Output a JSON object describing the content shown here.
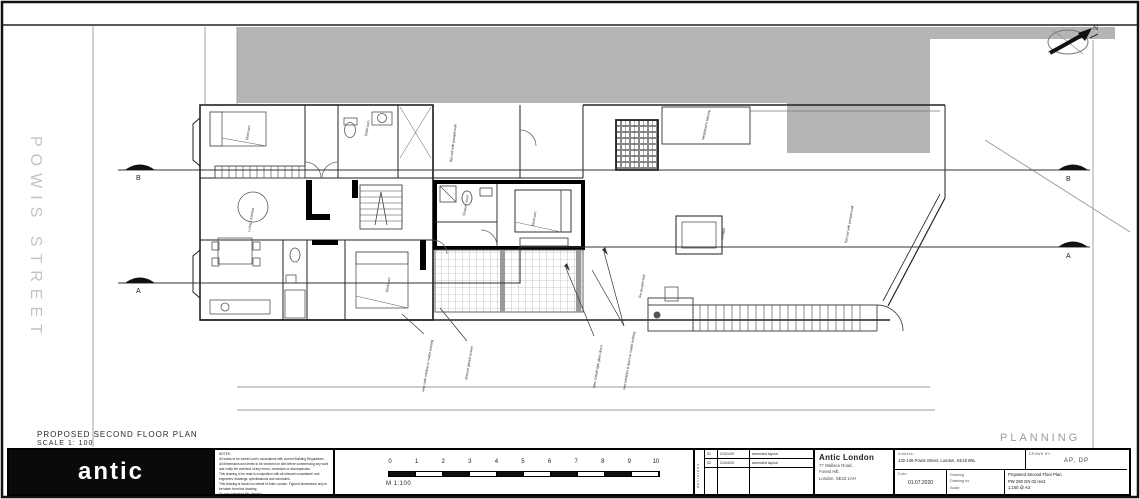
{
  "plan": {
    "street_label": "POWIS STREET",
    "title": "PROPOSED SECOND FLOOR PLAN",
    "scale_note": "SCALE 1: 100",
    "status": "PLANNING",
    "north_label": "N",
    "section_b": "B",
    "section_a": "A",
    "room_labels": [
      {
        "text": "Bedroom"
      },
      {
        "text": "Bathroom"
      },
      {
        "text": "Living / Kitchen"
      },
      {
        "text": "Bedroom"
      },
      {
        "text": "Bedroom"
      },
      {
        "text": "Shower room"
      }
    ],
    "annotations": [
      {
        "text": "flat roof with parapet wall"
      },
      {
        "text": "Neighbour's balcony"
      },
      {
        "text": "rooflight"
      },
      {
        "text": "flat roof with parapet wall"
      },
      {
        "text": "fire escape stair"
      },
      {
        "text": "New Crittall style glass doors"
      },
      {
        "text": "new windows & doors to match existing"
      },
      {
        "text": "new sash window to match existing"
      },
      {
        "text": "obscure glazed screen"
      }
    ]
  },
  "title_block": {
    "logo_text": "antic",
    "notes_lines": [
      "NOTES:",
      "All works to be carried out in accordance with current Building Regulations.",
      "All dimensions and levels to be checked on site before commencing any work and notify the architect of any errors, omissions or discrepancies.",
      "This drawing to be read in conjunction with all relevant consultants' and engineers' drawings, specifications and schedules.",
      "This drawing is issued on behalf of Antic London. Figured dimensions only to be taken from this drawing.",
      "Do not scale from this drawing."
    ],
    "scale_bar": {
      "ticks": [
        "0",
        "1",
        "2",
        "3",
        "4",
        "5",
        "6",
        "7",
        "8",
        "9",
        "10"
      ],
      "unit": "M 1:100"
    },
    "revisions": {
      "side_label": "REVISIONS",
      "rows": [
        {
          "no": "01",
          "date": "21/01/20",
          "desc": "amended layout"
        },
        {
          "no": "02",
          "date": "21/04/20",
          "desc": "amended layout"
        }
      ]
    },
    "practice": {
      "name": "Antic London",
      "address_lines": [
        "77 Wallace Road,",
        "Forest Hill,",
        "London, SE23 1AH"
      ]
    },
    "project": {
      "address_label": "Address:",
      "address_value": "132-136 Powis Street, London, SE18 6NL",
      "drawn_by_label": "DRAWN BY:",
      "drawn_by_value": "AP, DP",
      "date_label": "Date:",
      "date_value": "01.07.2020",
      "drawing_label": "Drawing",
      "drawing_no_label": "Drawing no.",
      "scale_label": "Scale",
      "drawing_value": "Proposed Second Floor Plan",
      "drawing_no_value": "PW 280 GN 02 rev2",
      "scale_value": "1:100 @ A3"
    }
  }
}
